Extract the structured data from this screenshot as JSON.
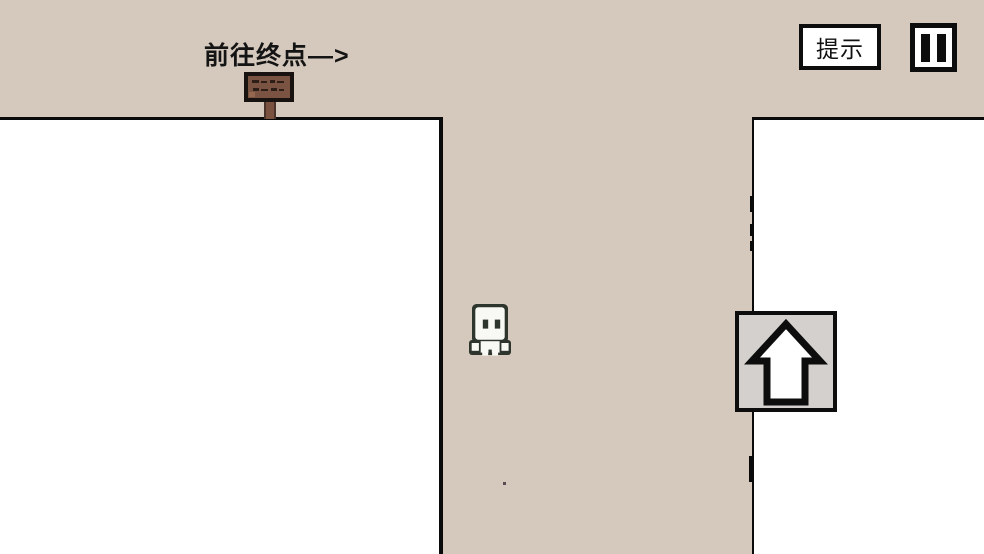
{
  "hud": {
    "instruction_text": "前往终点—>",
    "hint_button_label": "提示",
    "pause_icon": "pause-icon"
  },
  "icons": {
    "player": "white-pixel-ghost",
    "signpost": "wooden-signpost",
    "arrow_tile": "up-arrow-icon",
    "pause": "pause-icon"
  },
  "colors": {
    "background": "#d5c9bd",
    "wall": "#ffffff",
    "outline": "#0a0a0a",
    "arrow_tile_bg": "#d3d0cd",
    "sign_frame": "#181210",
    "sign_board": "#7b5342",
    "sign_marks": "#2e1e18",
    "sign_post": "#7b5140",
    "player_outline": "#2e352c",
    "player_body": "#f8f8f4"
  }
}
